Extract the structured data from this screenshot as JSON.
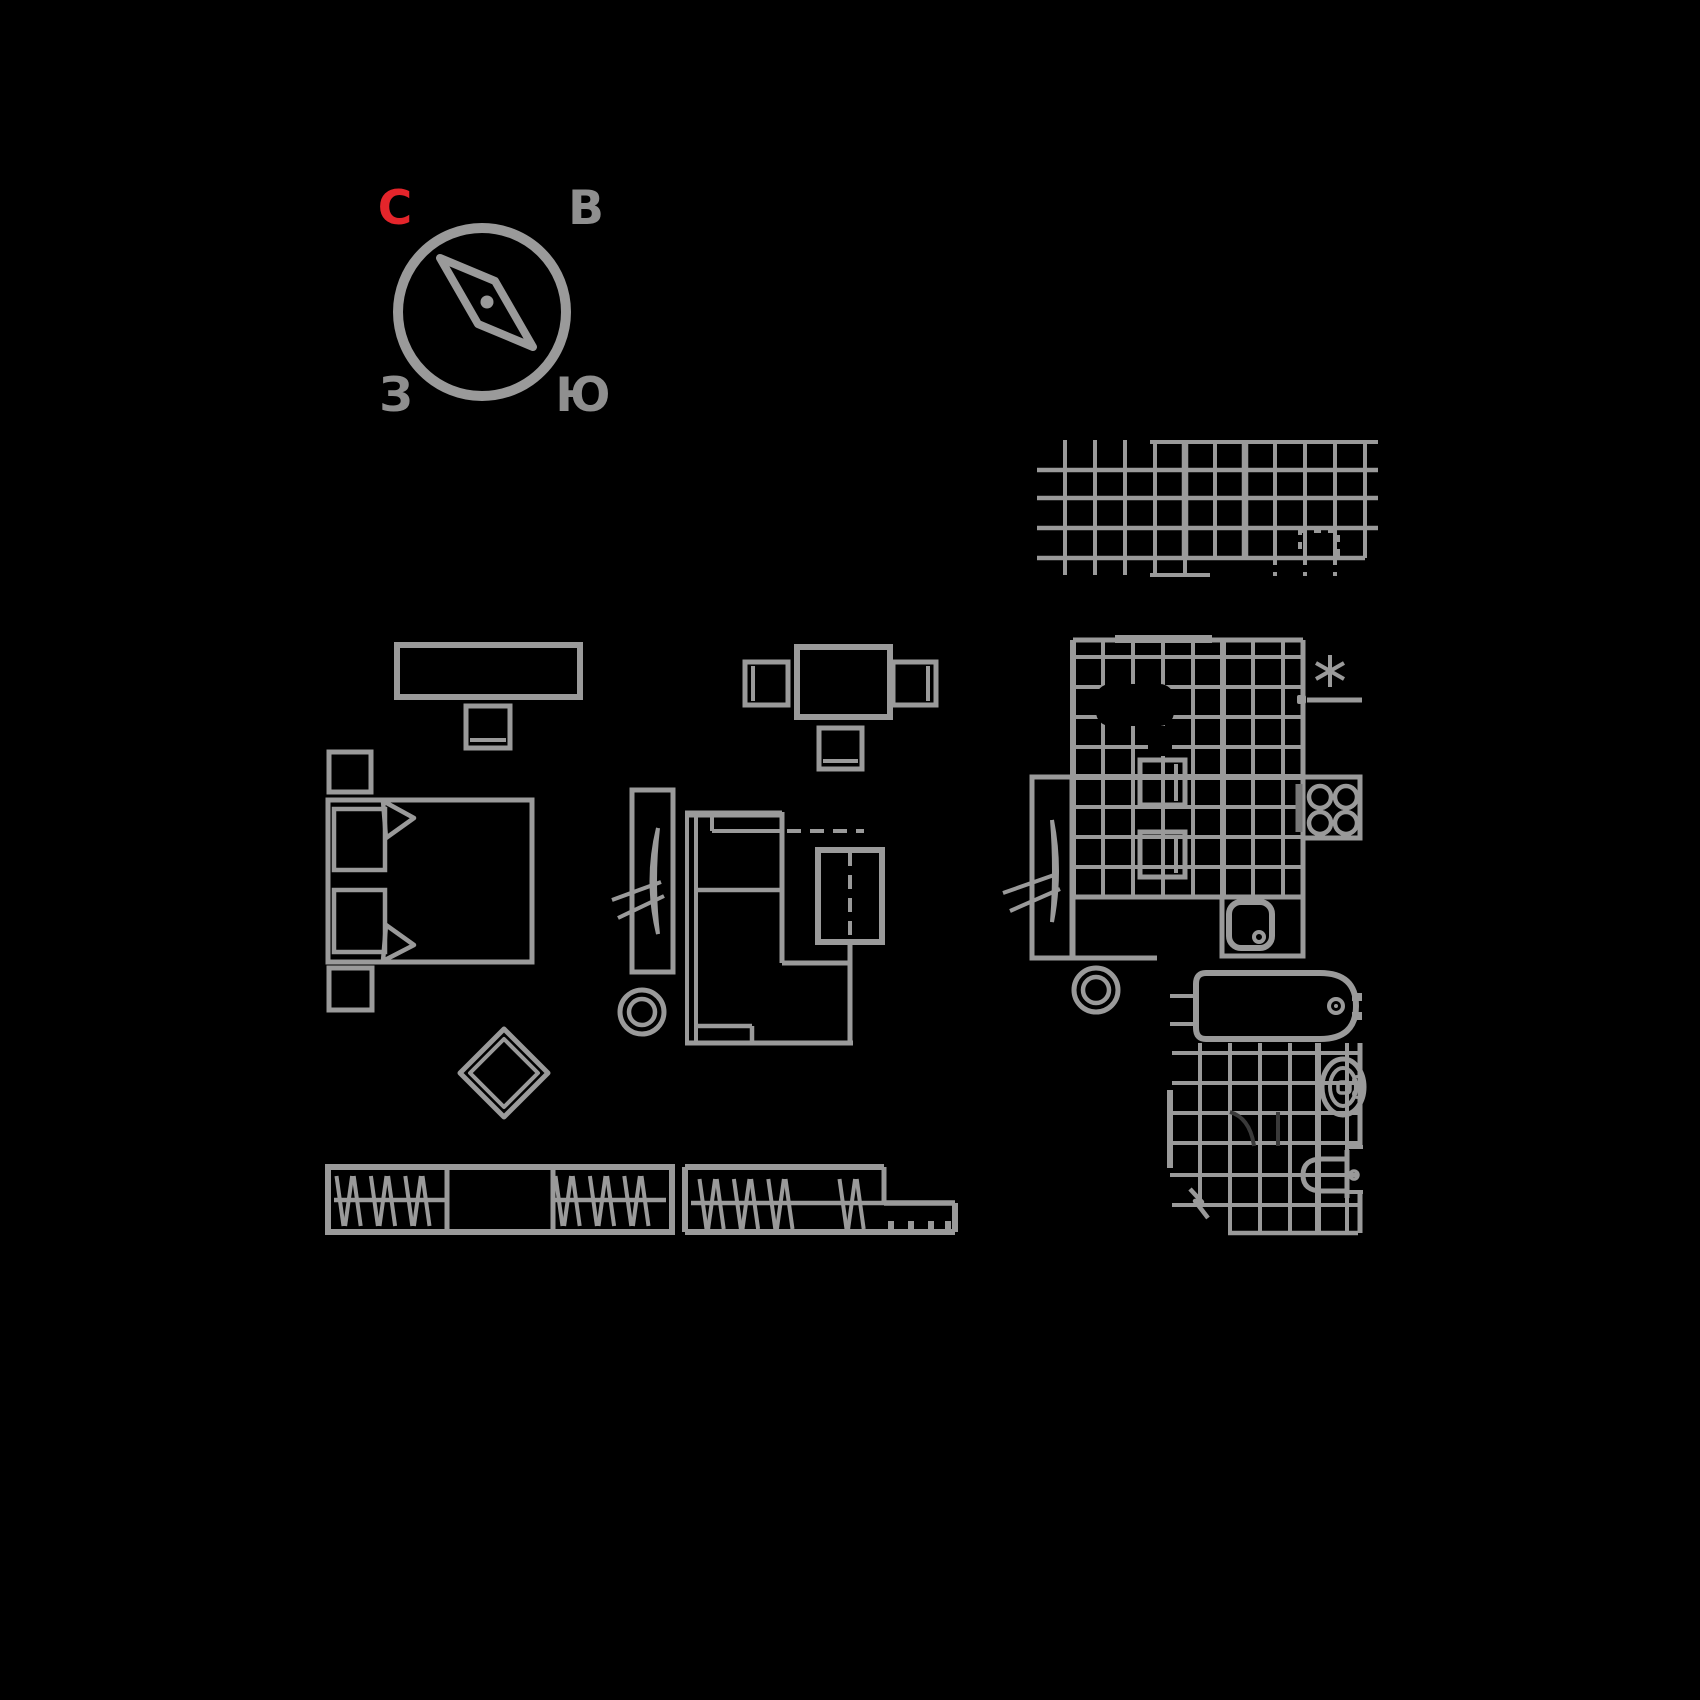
{
  "canvas": {
    "width": 1700,
    "height": 1700,
    "background": "#000000"
  },
  "palette": {
    "line_gray": "#9a9a9a",
    "dim_gray": "#787878",
    "faint_gray": "#3a3a3a",
    "accent_red": "#e4252b",
    "label_gray": "#8f8f8f"
  },
  "compass": {
    "labels": {
      "north": "С",
      "east": "В",
      "west": "З",
      "south": "Ю"
    },
    "north_color": "#e4252b",
    "other_color": "#8f8f8f"
  },
  "symbols": {
    "bedroom": [
      "dresser",
      "tv",
      "nightstand-top",
      "double-bed",
      "pillow-top",
      "pillow-bottom",
      "blanket-fold-top",
      "blanket-fold-bottom",
      "nightstand-bottom",
      "diamond-rug"
    ],
    "living_room": [
      "dining-table",
      "chair-left",
      "chair-right",
      "chair-bottom",
      "wardrobe-with-mirror",
      "floor-circle",
      "corner-sofa",
      "armchair"
    ],
    "kitchen": [
      "wall-tile-grid",
      "floor-tile-grid",
      "dining-stool-1",
      "dining-stool-2",
      "tall-cabinet-with-mirror",
      "floor-circle",
      "star-mark",
      "door-hinge",
      "wall-ledge",
      "stove-4-burners",
      "sink-unit"
    ],
    "bathroom": [
      "bathtub",
      "floor-tile-grid",
      "toilet",
      "washbasin",
      "electric-mark",
      "plumbing-ticks"
    ],
    "storage": [
      "closet-with-clothes-left",
      "closet-with-clothes-right",
      "shoe-shelf-ticks"
    ]
  }
}
